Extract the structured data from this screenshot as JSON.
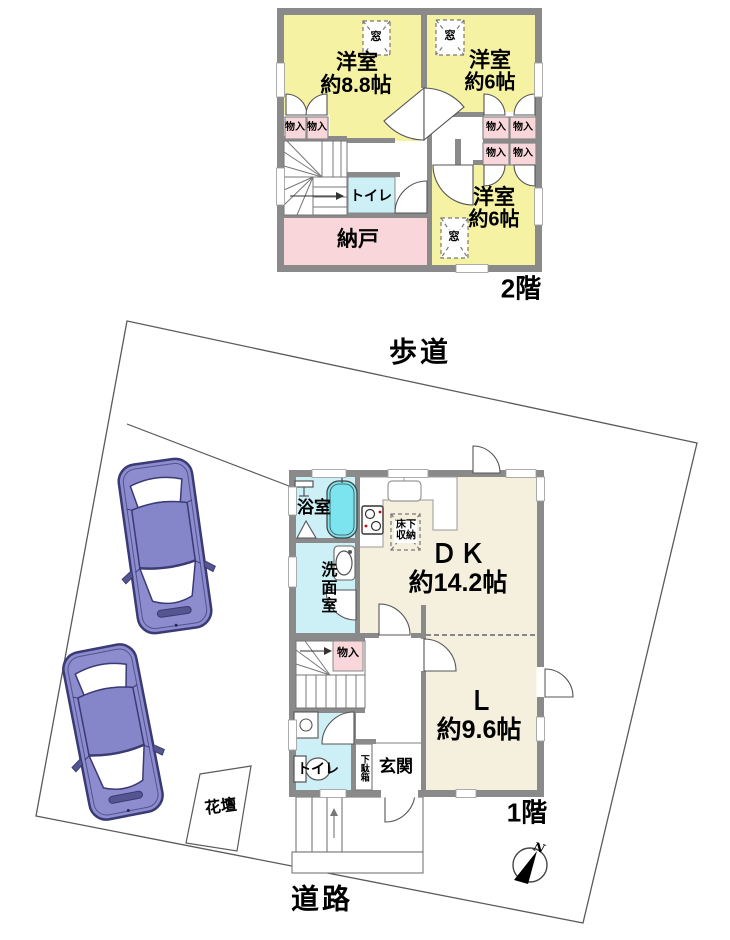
{
  "site": {
    "sidewalk_label": "歩道",
    "road_label": "道路",
    "flowerbed_label": "花壇",
    "compass_north": "N"
  },
  "floor2": {
    "floor_label": "2階",
    "room1_name": "洋室",
    "room1_size": "約8.8帖",
    "room2_name": "洋室",
    "room2_size": "約6帖",
    "room3_name": "洋室",
    "room3_size": "約6帖",
    "storage_label": "納戸",
    "toilet_label": "トイレ",
    "closet_label": "物入",
    "window_label": "窓"
  },
  "floor1": {
    "floor_label": "1階",
    "dk_name": "ＤＫ",
    "dk_size": "約14.2帖",
    "living_name": "Ｌ",
    "living_size": "約9.6帖",
    "bath_label": "浴室",
    "washroom_label": "洗面室",
    "toilet_label": "トイレ",
    "closet_label": "物入",
    "underfloor_label": "床下収納",
    "shoebox_label": "下駄箱",
    "entrance_label": "玄関"
  },
  "colors": {
    "room_yellow": "#f5f2a3",
    "room_pink": "#f8d6d9",
    "room_cyan": "#cdeff6",
    "bathtub_cyan": "#7ce4ee",
    "floor_beige": "#f5efdd",
    "wall_gray": "#8a8a8a",
    "car_purple": "#8c8cce",
    "line_gray": "#5a5a5a"
  }
}
